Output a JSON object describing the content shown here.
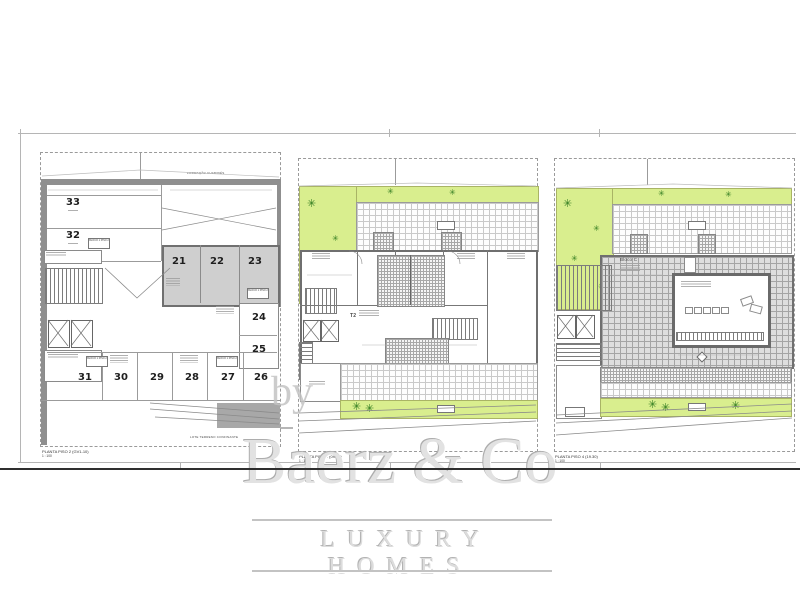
{
  "watermark": {
    "by_label": "by",
    "brand": "Baerz & Co",
    "tagline": "LUXURY HOMES"
  },
  "plans": {
    "garage": {
      "caption": "PLANTA PISO 2 (GV1-10)",
      "scale": "1 : 100",
      "top_note": "FORMAÇÃO CHAMINÉS",
      "boundary_note": "LOTE TERRENO CONFINANTE",
      "block_tag": "BLOCO 1 PISO 2",
      "spaces_left": [
        "33",
        "32"
      ],
      "spaces_gray": [
        "21",
        "22",
        "23"
      ],
      "spaces_right": [
        "24",
        "25"
      ],
      "spaces_bottom": [
        "31",
        "30",
        "29",
        "28",
        "27",
        "26"
      ]
    },
    "floor": {
      "caption": "PLANTA PISO 1 (09.30)",
      "scale": "1 : 100",
      "unit_tag": "T2"
    },
    "roof": {
      "caption": "PLANTA PISO 4 (19.30)",
      "scale": "1 : 100",
      "block_tag": "Bloco C"
    }
  },
  "icons": {
    "plant_icon": "✳"
  },
  "colors": {
    "lawn": "#d9ee8e",
    "plant_green": "#2f7a1f",
    "wall_gray": "#8f8f8f",
    "parking_shade": "#cfcfcf",
    "roof_tile": "#dedede",
    "watermark_gray": "#d8d8d8",
    "frame_dark": "#2f2f2f"
  }
}
